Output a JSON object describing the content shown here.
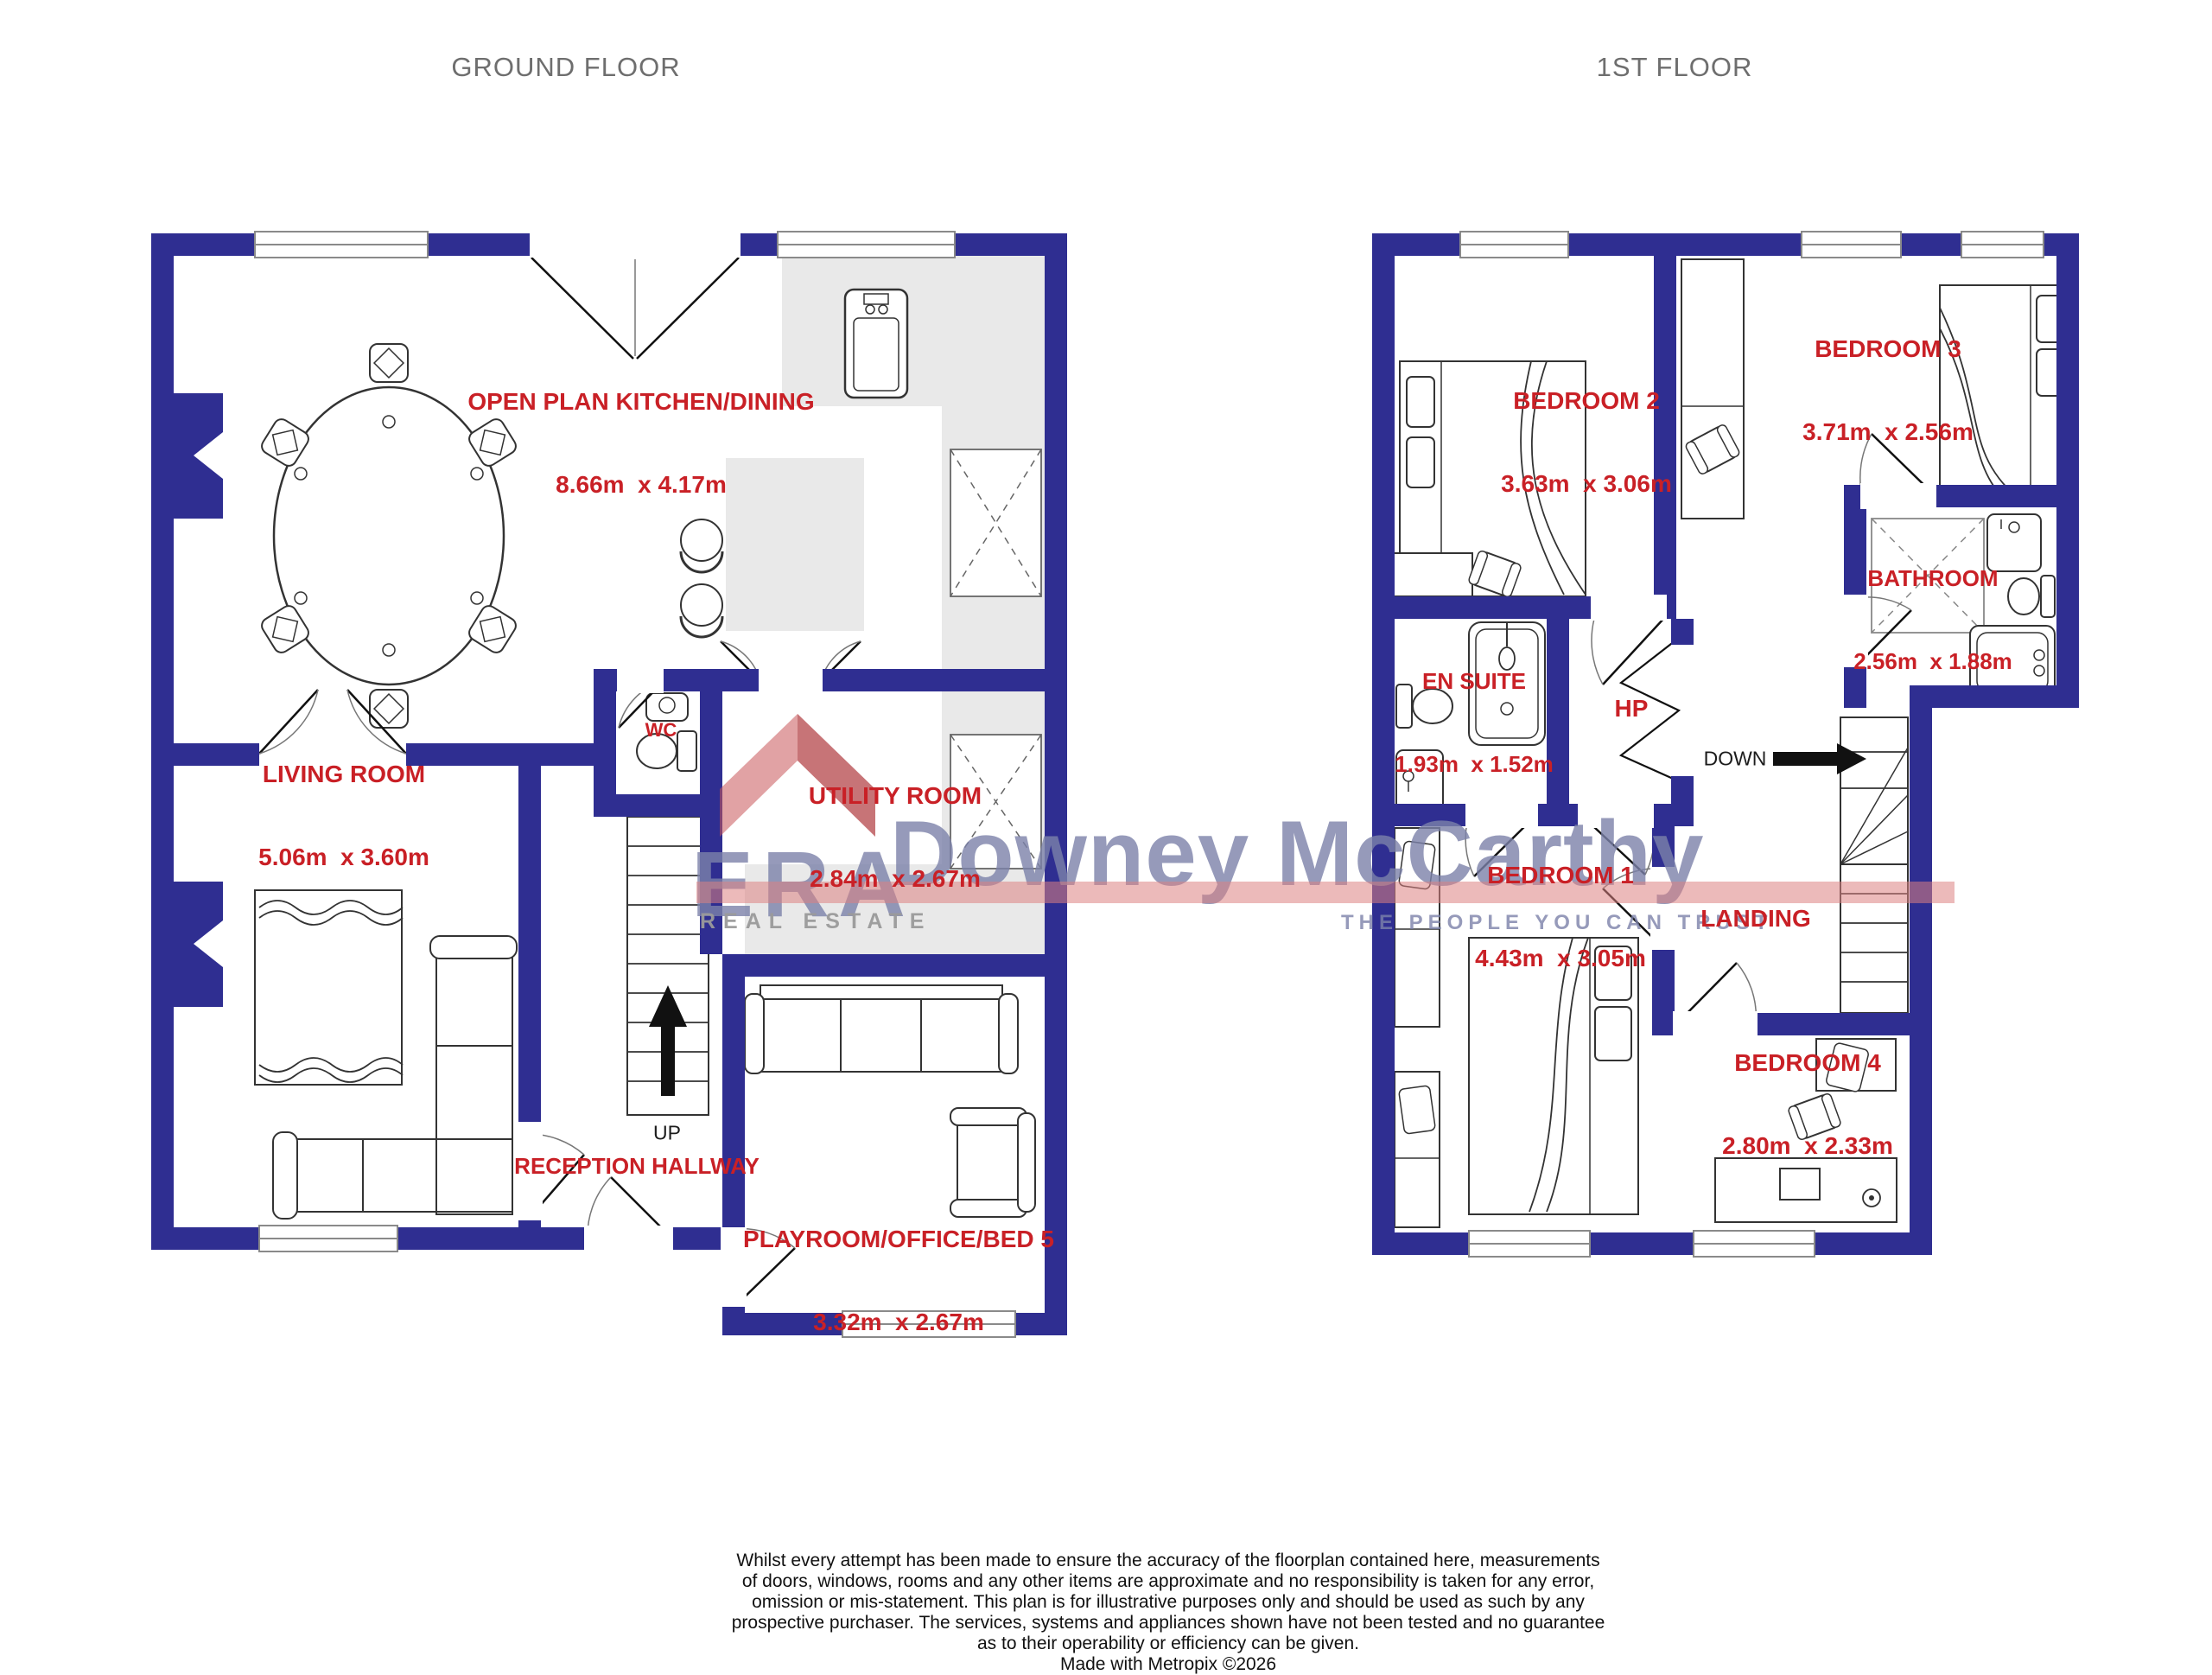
{
  "titles": {
    "ground": "GROUND FLOOR",
    "first": "1ST FLOOR"
  },
  "rooms": {
    "kitchen": {
      "name": "OPEN PLAN KITCHEN/DINING",
      "dims": "8.66m  x 4.17m"
    },
    "living": {
      "name": "LIVING ROOM",
      "dims": "5.06m  x 3.60m"
    },
    "wc": {
      "name": "WC"
    },
    "utility": {
      "name": "UTILITY ROOM",
      "dims": "2.84m  x 2.67m"
    },
    "hallway": {
      "name": "RECEPTION HALLWAY"
    },
    "playroom": {
      "name": "PLAYROOM/OFFICE/BED 5",
      "dims": "3.32m  x 2.67m"
    },
    "bedroom2": {
      "name": "BEDROOM 2",
      "dims": "3.63m  x 3.06m"
    },
    "bedroom3": {
      "name": "BEDROOM 3",
      "dims": "3.71m  x 2.56m"
    },
    "bathroom": {
      "name": "BATHROOM",
      "dims": "2.56m  x 1.88m"
    },
    "ensuite": {
      "name": "EN SUITE",
      "dims": "1.93m  x 1.52m"
    },
    "hp": {
      "name": "HP"
    },
    "landing": {
      "name": "LANDING"
    },
    "bedroom1": {
      "name": "BEDROOM 1",
      "dims": "4.43m  x 3.05m"
    },
    "bedroom4": {
      "name": "BEDROOM 4",
      "dims": "2.80m  x 2.33m"
    }
  },
  "stairs": {
    "up": "UP",
    "down": "DOWN"
  },
  "watermark": {
    "era": "ERA",
    "name": "Downey McCarthy",
    "left_tag": "REAL ESTATE",
    "right_tag": "THE PEOPLE YOU CAN TRUST"
  },
  "disclaimer": "Whilst every attempt has been made to ensure the accuracy of the floorplan contained here, measurements\nof doors, windows, rooms and any other items are approximate and no responsibility is taken for any error,\nomission or mis-statement. This plan is for illustrative purposes only and should be used as such by any\nprospective purchaser. The services, systems and appliances shown have not been tested and no guarantee\nas to their operability or efficiency can be given.\nMade with Metropix ©2026",
  "colors": {
    "wall": "#2F2E91",
    "label": "#C92026",
    "title": "#6E6E6E",
    "counter": "#E9E9E9",
    "line": "#333333",
    "thin": "#777777",
    "wm_text": "#7C82AA",
    "wm_red": "#DD8181"
  }
}
